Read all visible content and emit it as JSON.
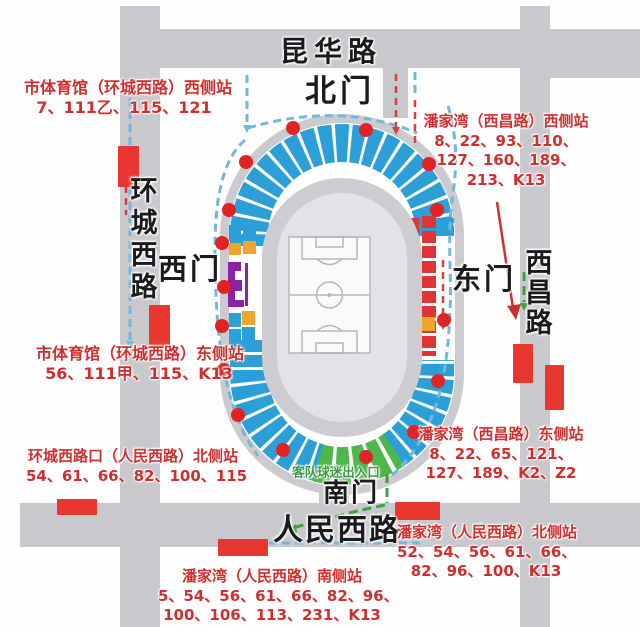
{
  "map": {
    "road_labels": {
      "north_road": "昆华路",
      "west_road": "环城西路",
      "east_road": "西昌路",
      "south_road": "人民西路"
    },
    "gate_labels": {
      "north": "北门",
      "west": "西门",
      "east": "东门",
      "south": "南门"
    },
    "entrance_label": "客队球迷出入口",
    "stations": [
      {
        "id": "shitiyuguan-huanchengxilu-west",
        "lines": [
          "市体育馆（环城西路）西侧站",
          "7、111乙、115、121"
        ]
      },
      {
        "id": "panjiawan-xichanglu-west",
        "lines": [
          "潘家湾（西昌路）西侧站",
          "8、22、93、110、",
          "127、160、189、",
          "213、K13"
        ]
      },
      {
        "id": "shitiyuguan-huanchengxilu-east",
        "lines": [
          "市体育馆（环城西路）东侧站",
          "56、111甲、115、K13"
        ]
      },
      {
        "id": "huanchengxilukou-renminxilu-north",
        "lines": [
          "环城西路口（人民西路）北侧站",
          "54、61、66、82、100、115"
        ]
      },
      {
        "id": "panjiawan-xichanglu-east",
        "lines": [
          "潘家湾（西昌路）东侧站",
          "8、22、65、121、",
          "127、189、K2、Z2"
        ]
      },
      {
        "id": "panjiawan-renminxilu-north",
        "lines": [
          "潘家湾（人民西路）北侧站",
          "52、54、56、61、66、",
          "82、96、100、K13"
        ]
      },
      {
        "id": "panjiawan-renminxilu-south",
        "lines": [
          "潘家湾（人民西路）南侧站",
          "5、54、56、61、66、82、96、",
          "100、106、113、231、K13"
        ]
      }
    ]
  },
  "colors": {
    "road_gray": "#c9c9cd",
    "stadium_ring": "#cbcbcf",
    "bowl_gray": "#cdcdd1",
    "bowl_inner": "#e3e3e7",
    "seat_blue": "#2d9fd8",
    "seat_green": "#4eb74b",
    "seat_red": "#e23434",
    "seat_orange": "#f0a62c",
    "seat_purple": "#8b22a5",
    "stop_red": "#e8372f",
    "dot_red": "#e02424",
    "route_blue": "#74b7da",
    "route_red": "#d84040",
    "route_green": "#3da244",
    "arrow_red": "#d02f2f",
    "station_text": "#d02f2f",
    "road_text": "#1b1b1d",
    "entrance_text": "#3b9b3f"
  }
}
